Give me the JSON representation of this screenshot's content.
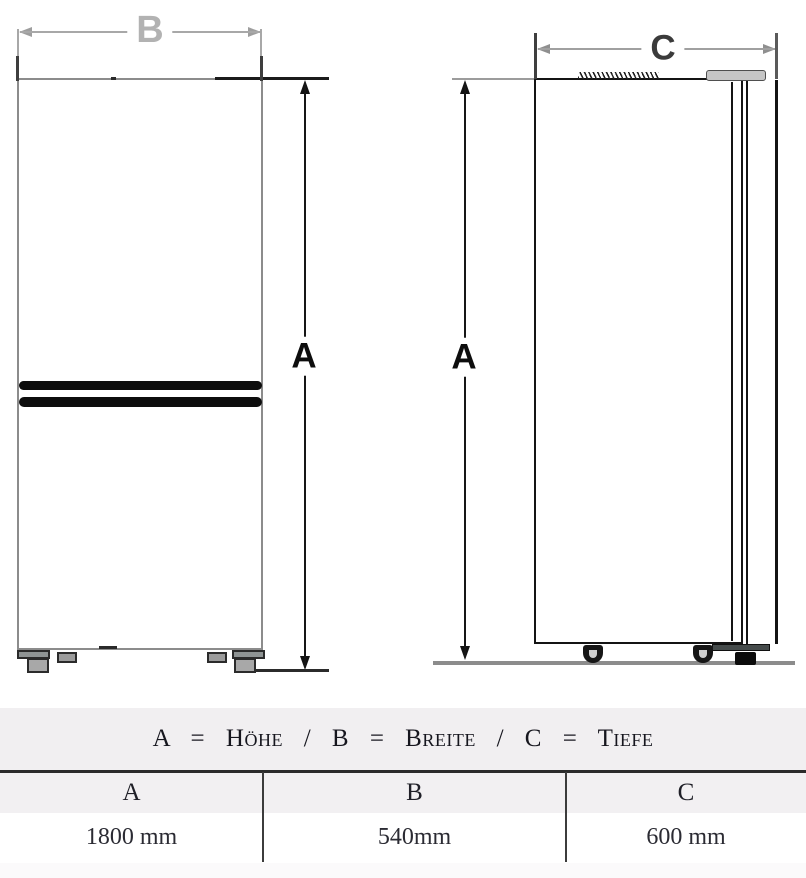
{
  "diagram": {
    "dimension_labels": {
      "height": "A",
      "width": "B",
      "depth": "C"
    }
  },
  "legend": {
    "caption": "A = Höhe / B = Breite / C = Tiefe"
  },
  "table": {
    "headers": [
      "A",
      "B",
      "C"
    ],
    "values": [
      "1800 mm",
      "540mm",
      "600 mm"
    ]
  },
  "colors": {
    "dimension_line_black": "#161616",
    "dimension_line_gray": "#a8a8a8",
    "outline_gray": "#8c8c8c",
    "ground_gray": "#8c8c8c",
    "legend_band_bg": "#f1eff1",
    "table_border": "#2b2b2b"
  }
}
